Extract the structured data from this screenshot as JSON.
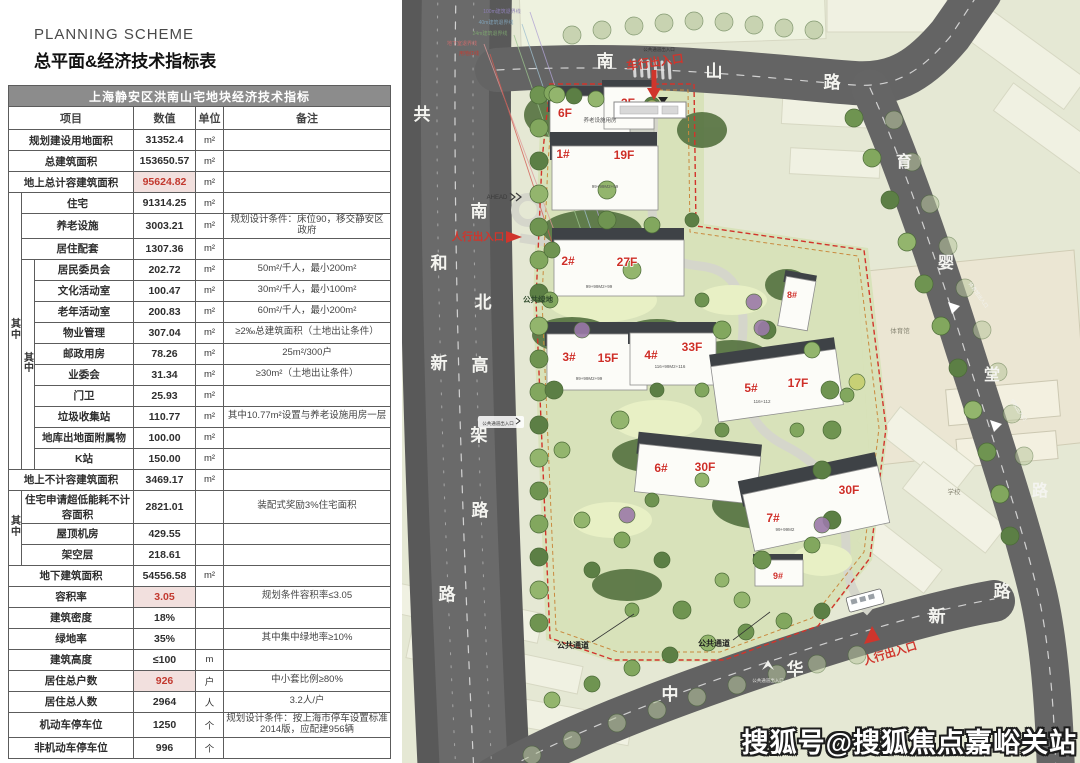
{
  "header": {
    "title_en": "PLANNING SCHEME",
    "title_zh": "总平面&经济技术指标表"
  },
  "table": {
    "title": "上海静安区洪南山宅地块经济技术指标",
    "columns": [
      "项目",
      "数值",
      "单位",
      "备注"
    ],
    "group_label": "其中",
    "rows": [
      {
        "item": "规划建设用地面积",
        "value": "31352.4",
        "unit": "m²",
        "note": "",
        "indent": 0
      },
      {
        "item": "总建筑面积",
        "value": "153650.57",
        "unit": "m²",
        "note": "",
        "indent": 0
      },
      {
        "item": "地上总计容建筑面积",
        "value": "95624.82",
        "unit": "m²",
        "note": "",
        "indent": 0,
        "red": true
      },
      {
        "item": "住宅",
        "value": "91314.25",
        "unit": "m²",
        "note": "",
        "indent": 1,
        "g1": 13
      },
      {
        "item": "养老设施",
        "value": "3003.21",
        "unit": "m²",
        "note": "规划设计条件：床位90，移交静安区政府",
        "indent": 1
      },
      {
        "item": "居住配套",
        "value": "1307.36",
        "unit": "m²",
        "note": "",
        "indent": 1
      },
      {
        "item": "居民委员会",
        "value": "202.72",
        "unit": "m²",
        "note": "50m²/千人，最小200m²",
        "indent": 2,
        "g2": 10
      },
      {
        "item": "文化活动室",
        "value": "100.47",
        "unit": "m²",
        "note": "30m²/千人，最小100m²",
        "indent": 2
      },
      {
        "item": "老年活动室",
        "value": "200.83",
        "unit": "m²",
        "note": "60m²/千人，最小200m²",
        "indent": 2
      },
      {
        "item": "物业管理",
        "value": "307.04",
        "unit": "m²",
        "note": "≥2‰总建筑面积（土地出让条件）",
        "indent": 2
      },
      {
        "item": "邮政用房",
        "value": "78.26",
        "unit": "m²",
        "note": "25m²/300户",
        "indent": 2
      },
      {
        "item": "业委会",
        "value": "31.34",
        "unit": "m²",
        "note": "≥30m²（土地出让条件）",
        "indent": 2
      },
      {
        "item": "门卫",
        "value": "25.93",
        "unit": "m²",
        "note": "",
        "indent": 2
      },
      {
        "item": "垃圾收集站",
        "value": "110.77",
        "unit": "m²",
        "note": "其中10.77m²设置与养老设施用房一层",
        "indent": 2
      },
      {
        "item": "地库出地面附属物",
        "value": "100.00",
        "unit": "m²",
        "note": "",
        "indent": 2
      },
      {
        "item": "K站",
        "value": "150.00",
        "unit": "m²",
        "note": "",
        "indent": 2
      },
      {
        "item": "地上不计容建筑面积",
        "value": "3469.17",
        "unit": "m²",
        "note": "",
        "indent": 0
      },
      {
        "item": "住宅申请超低能耗不计容面积",
        "value": "2821.01",
        "unit": "",
        "note": "装配式奖励3%住宅面积",
        "indent": 1,
        "g1": 3
      },
      {
        "item": "屋顶机房",
        "value": "429.55",
        "unit": "",
        "note": "",
        "indent": 1
      },
      {
        "item": "架空层",
        "value": "218.61",
        "unit": "",
        "note": "",
        "indent": 1
      },
      {
        "item": "地下建筑面积",
        "value": "54556.58",
        "unit": "m²",
        "note": "",
        "indent": 0
      },
      {
        "item": "容积率",
        "value": "3.05",
        "unit": "",
        "note": "规划条件容积率≤3.05",
        "indent": 0,
        "red": true
      },
      {
        "item": "建筑密度",
        "value": "18%",
        "unit": "",
        "note": "",
        "indent": 0
      },
      {
        "item": "绿地率",
        "value": "35%",
        "unit": "",
        "note": "其中集中绿地率≥10%",
        "indent": 0
      },
      {
        "item": "建筑高度",
        "value": "≤100",
        "unit": "m",
        "note": "",
        "indent": 0
      },
      {
        "item": "居住总户数",
        "value": "926",
        "unit": "户",
        "note": "中小套比例≥80%",
        "indent": 0,
        "red": true
      },
      {
        "item": "居住总人数",
        "value": "2964",
        "unit": "人",
        "note": "3.2人/户",
        "indent": 0
      },
      {
        "item": "机动车停车位",
        "value": "1250",
        "unit": "个",
        "note": "规划设计条件：按上海市停车设置标准2014版，应配建956辆",
        "indent": 0
      },
      {
        "item": "非机动车停车位",
        "value": "996",
        "unit": "个",
        "note": "",
        "indent": 0
      }
    ]
  },
  "plan": {
    "road_names": {
      "gonghexin": "共和新路",
      "nanbei_gaojia": "南北高架路",
      "nanshan": "南山路",
      "yuyingtang": "育婴堂路",
      "zhonghuaxin": "中华新路"
    },
    "buildings": [
      {
        "floors": "6F",
        "name": "养老设施用房"
      },
      {
        "floors": "3F"
      },
      {
        "num": "1#",
        "floors": "19F",
        "units": "99+99M2+99"
      },
      {
        "num": "2#",
        "floors": "27F",
        "units": "99+99M2+99"
      },
      {
        "num": "3#",
        "floors": "15F",
        "units": "99+99M2+99"
      },
      {
        "num": "4#",
        "floors": "33F",
        "units": "116+99M2+116"
      },
      {
        "num": "5#",
        "floors": "17F",
        "units": "116+112"
      },
      {
        "num": "8#"
      },
      {
        "num": "6#",
        "floors": "30F"
      },
      {
        "num": "7#",
        "floors": "30F",
        "units": "99+99M2"
      },
      {
        "num": "9#"
      }
    ],
    "labels": {
      "vehicle_entrance": "车行出入口",
      "pedestrian_entrance": "人行出入口",
      "public_channel": "公共通道",
      "public_channel_entrance": "公共通道出入口",
      "public_green": "公共绿地",
      "gym": "体育馆",
      "gym_entrance": "体育馆出入口",
      "school": "学校",
      "school_entrance": "学校出入口",
      "ahead": "AHEAD"
    },
    "setback_labels": [
      "100m建筑退界线",
      "40m建筑退界线",
      "24m建筑退界线",
      "地下室退界线",
      "用地红线"
    ]
  },
  "watermark": "搜狐号@搜狐焦点嘉峪关站"
}
